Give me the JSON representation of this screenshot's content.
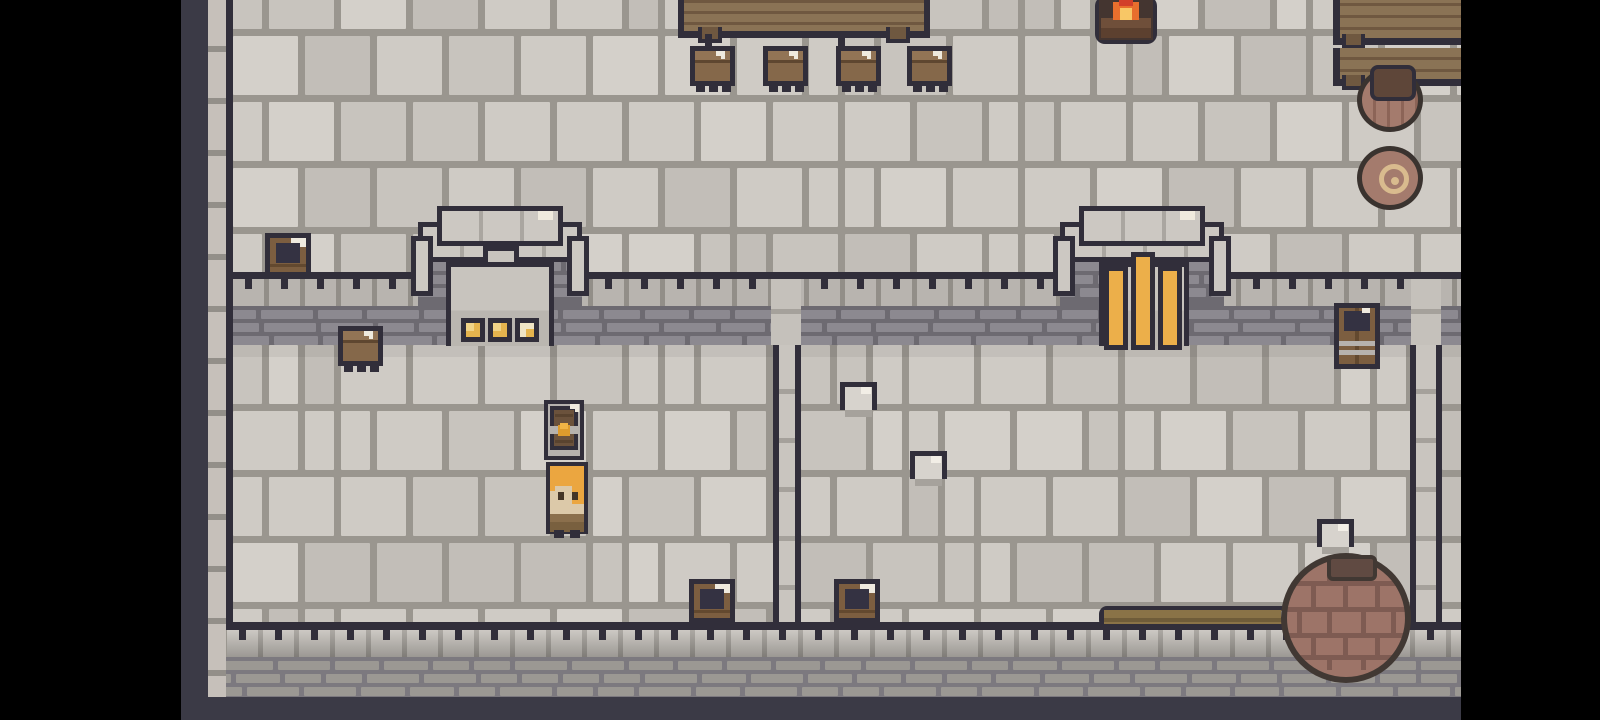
{
  "meta": {
    "scene": "pixel-art top-down castle interior",
    "visible_text": ""
  },
  "palette": {
    "letterbox": "#000000",
    "edge_slate": "#3b3a46",
    "outline": "#312e3a",
    "floor_grout": "#9a968f",
    "band_tile": "#b8b4af",
    "brick": "#8c8990",
    "brick_gap": "#6d6a71",
    "outer_brick": "#9b9893",
    "outer_brick_gap": "#7c797f",
    "wood": "#8a7355",
    "wood_dark": "#6f5840",
    "crate_wood": "#7c5e40",
    "crate_interior": "#343242",
    "highlight_white": "#efeade",
    "stone_block": "#d7d3cd",
    "stone_shadow": "#a6a29c",
    "gold": "#e5b44e",
    "portcullis_gold": "#ecaf4a",
    "clasp_gold": "#dd9b2d",
    "barrel_rose": "#a47b6d",
    "barrel_cap": "#5e4639",
    "coil": "#d9bb8e",
    "big_pot": "#9d7468",
    "big_pot_band": "#7e5b52",
    "flame_red": "#d2402a",
    "flame_orange": "#e86f2d",
    "flame_yellow": "#f8c766",
    "log": "#6f4f3a",
    "hair": "#eba640",
    "skin": "#dcc9a9",
    "eye": "#443527",
    "shirt": "#8b6f4c",
    "arch_stone": "#ccc8c2",
    "alcove": "#c8c4be"
  },
  "viewport": {
    "x": 181,
    "y": 0,
    "w": 1280,
    "h": 720
  },
  "tile_variants": [
    "#cfcbc5",
    "#cfcbc5",
    "#c8c4be",
    "#d4d0ca",
    "#c2beb8"
  ],
  "floors": [
    {
      "name": "hall-floor",
      "x": 52,
      "y": 0,
      "w": 1228,
      "h": 272,
      "oy": -30
    },
    {
      "name": "room-left-floor",
      "x": 52,
      "y": 345,
      "w": 540,
      "h": 277
    },
    {
      "name": "room-mid-floor",
      "x": 620,
      "y": 345,
      "w": 609,
      "h": 277
    },
    {
      "name": "room-right-floor",
      "x": 1261,
      "y": 345,
      "w": 19,
      "h": 277
    }
  ],
  "structure": [
    {
      "type": "shade",
      "name": "wall-shadow",
      "x": 52,
      "y": 345,
      "w": 1228,
      "h": 12
    },
    {
      "type": "line",
      "name": "hall-wall-line",
      "x": 52,
      "y": 272,
      "w": 1228,
      "h": 7
    },
    {
      "type": "tilerow-i",
      "name": "wall-tile-row",
      "x": 52,
      "y": 279,
      "w": 1228,
      "h": 27
    },
    {
      "type": "bricks-i",
      "name": "wall-brick-band",
      "x": 52,
      "y": 306,
      "w": 1228,
      "h": 39
    },
    {
      "type": "ticks",
      "name": "wall-ticks",
      "x": 52,
      "y": 279,
      "w": 1228,
      "spacing": 36
    },
    {
      "type": "bricks-i",
      "name": "arch-brick-apron",
      "x": 237,
      "y": 258,
      "w": 164,
      "h": 48
    },
    {
      "type": "bricks-i",
      "name": "arch-brick-apron",
      "x": 879,
      "y": 258,
      "w": 164,
      "h": 48
    },
    {
      "type": "divider-top",
      "name": "divider-wall-top",
      "x": 590,
      "y": 279,
      "w": 30,
      "h": 66
    },
    {
      "type": "divider-top",
      "name": "divider-wall-top",
      "x": 1230,
      "y": 279,
      "w": 30,
      "h": 66
    },
    {
      "type": "divider",
      "name": "divider-wall",
      "x": 592,
      "y": 345,
      "w": 28,
      "h": 277
    },
    {
      "type": "divider",
      "name": "divider-wall",
      "x": 1229,
      "y": 345,
      "w": 32,
      "h": 277
    },
    {
      "type": "line",
      "name": "south-wall-line",
      "x": 46,
      "y": 622,
      "w": 1234,
      "h": 8
    },
    {
      "type": "tilerow-o",
      "name": "south-tile-row",
      "x": 46,
      "y": 630,
      "w": 1234,
      "h": 27
    },
    {
      "type": "ticks",
      "name": "south-ticks",
      "x": 46,
      "y": 630,
      "w": 1234,
      "spacing": 36
    },
    {
      "type": "bricks-o",
      "name": "south-brick-band",
      "x": 27,
      "y": 657,
      "w": 1253,
      "h": 40
    },
    {
      "type": "slate",
      "name": "south-edge",
      "x": 0,
      "y": 697,
      "w": 1280,
      "h": 23
    },
    {
      "type": "slate",
      "name": "west-edge",
      "x": 0,
      "y": 0,
      "w": 27,
      "h": 720
    },
    {
      "type": "brickcol",
      "name": "west-wall-column",
      "x": 27,
      "y": 0,
      "w": 18,
      "h": 697
    },
    {
      "type": "darkline",
      "name": "west-wall-line",
      "x": 45,
      "y": 0,
      "w": 7,
      "h": 630
    }
  ],
  "entities": [
    {
      "type": "table",
      "name": "banquet-table",
      "x": 497,
      "y": -8,
      "w": 252,
      "h": 46,
      "i": true
    },
    {
      "type": "hook",
      "name": "stool-hook",
      "x": 524,
      "y": 34,
      "w": 7,
      "h": 14,
      "i": false
    },
    {
      "type": "hook",
      "name": "stool-hook",
      "x": 657,
      "y": 34,
      "w": 7,
      "h": 14,
      "i": false
    },
    {
      "type": "stool",
      "name": "stool",
      "x": 509,
      "y": 46,
      "w": 45,
      "h": 46,
      "i": true
    },
    {
      "type": "stool",
      "name": "stool",
      "x": 582,
      "y": 46,
      "w": 45,
      "h": 46,
      "i": true
    },
    {
      "type": "stool",
      "name": "stool",
      "x": 655,
      "y": 46,
      "w": 45,
      "h": 46,
      "i": true
    },
    {
      "type": "stool",
      "name": "stool",
      "x": 726,
      "y": 46,
      "w": 45,
      "h": 46,
      "i": true
    },
    {
      "type": "fire",
      "name": "campfire",
      "x": 914,
      "y": -4,
      "w": 62,
      "h": 48,
      "i": true
    },
    {
      "type": "table-r",
      "name": "table-right-upper",
      "x": 1152,
      "y": -6,
      "w": 129,
      "h": 51,
      "i": true
    },
    {
      "type": "table-r",
      "name": "table-right-lower",
      "x": 1152,
      "y": 48,
      "w": 129,
      "h": 38,
      "i": true
    },
    {
      "type": "barrel-top",
      "name": "storage-barrel",
      "x": 1176,
      "y": 68,
      "w": 66,
      "h": 64,
      "i": true
    },
    {
      "type": "pot-coil",
      "name": "rope-coil-pot",
      "x": 1176,
      "y": 146,
      "w": 66,
      "h": 64,
      "i": true
    },
    {
      "type": "crate",
      "name": "open-crate",
      "x": 84,
      "y": 233,
      "w": 46,
      "h": 44,
      "i": true
    },
    {
      "type": "cap",
      "name": "arch-cap-outer",
      "x": 237,
      "y": 222,
      "w": 164,
      "h": 40,
      "i": false
    },
    {
      "type": "cap",
      "variant": "inner",
      "name": "arch-cap-inner",
      "x": 256,
      "y": 206,
      "w": 126,
      "h": 40,
      "i": false
    },
    {
      "type": "col",
      "name": "arch-column",
      "x": 230,
      "y": 236,
      "w": 22,
      "h": 60,
      "i": false
    },
    {
      "type": "col",
      "name": "arch-column",
      "x": 386,
      "y": 236,
      "w": 22,
      "h": 60,
      "i": false
    },
    {
      "type": "notch",
      "name": "arch-notch",
      "x": 302,
      "y": 246,
      "w": 36,
      "h": 22,
      "i": false
    },
    {
      "type": "alcove",
      "name": "arch-alcove",
      "x": 265,
      "y": 262,
      "w": 108,
      "h": 84,
      "i": false
    },
    {
      "type": "gold",
      "name": "altar-gold-tile",
      "x": 280,
      "y": 318,
      "w": 24,
      "h": 24,
      "i": false
    },
    {
      "type": "gold",
      "name": "altar-gold-tile",
      "x": 307,
      "y": 318,
      "w": 24,
      "h": 24,
      "i": false
    },
    {
      "type": "gold",
      "variant": "pale",
      "name": "altar-gold-tile",
      "x": 334,
      "y": 318,
      "w": 24,
      "h": 24,
      "i": false
    },
    {
      "type": "cap",
      "name": "arch-cap-outer",
      "x": 879,
      "y": 222,
      "w": 164,
      "h": 40,
      "i": false
    },
    {
      "type": "cap",
      "variant": "inner",
      "name": "arch-cap-inner",
      "x": 898,
      "y": 206,
      "w": 126,
      "h": 40,
      "i": false
    },
    {
      "type": "col",
      "name": "arch-column",
      "x": 872,
      "y": 236,
      "w": 22,
      "h": 60,
      "i": false
    },
    {
      "type": "col",
      "name": "arch-column",
      "x": 1028,
      "y": 236,
      "w": 22,
      "h": 60,
      "i": false
    },
    {
      "type": "backing",
      "name": "gate-recess",
      "x": 918,
      "y": 262,
      "w": 90,
      "h": 84,
      "i": false
    },
    {
      "type": "bar",
      "variant": "c",
      "name": "portcullis-bar",
      "x": 950,
      "y": 252,
      "w": 24,
      "h": 98,
      "i": true
    },
    {
      "type": "bar",
      "variant": "s",
      "name": "portcullis-bar",
      "x": 923,
      "y": 266,
      "w": 24,
      "h": 84,
      "i": true
    },
    {
      "type": "bar",
      "variant": "s",
      "name": "portcullis-bar",
      "x": 977,
      "y": 266,
      "w": 24,
      "h": 84,
      "i": true
    },
    {
      "type": "stool",
      "name": "stool",
      "x": 157,
      "y": 326,
      "w": 45,
      "h": 46,
      "i": true
    },
    {
      "type": "wbarrel",
      "name": "wall-barrel",
      "x": 1153,
      "y": 303,
      "w": 46,
      "h": 66,
      "i": true
    },
    {
      "type": "chest",
      "name": "treasure-chest",
      "x": 363,
      "y": 400,
      "w": 40,
      "h": 60,
      "i": true
    },
    {
      "type": "player",
      "name": "player-character",
      "x": 365,
      "y": 462,
      "w": 42,
      "h": 76,
      "i": true
    },
    {
      "type": "block",
      "name": "stone-block",
      "x": 659,
      "y": 382,
      "w": 37,
      "h": 35,
      "i": true
    },
    {
      "type": "block",
      "name": "stone-block",
      "x": 729,
      "y": 451,
      "w": 37,
      "h": 35,
      "i": true
    },
    {
      "type": "block",
      "name": "stone-block",
      "x": 1136,
      "y": 519,
      "w": 37,
      "h": 35,
      "i": true
    },
    {
      "type": "crate",
      "name": "open-crate",
      "x": 508,
      "y": 579,
      "w": 46,
      "h": 44,
      "i": true
    },
    {
      "type": "crate",
      "name": "open-crate",
      "x": 653,
      "y": 579,
      "w": 46,
      "h": 44,
      "i": true
    },
    {
      "type": "stick",
      "name": "wooden-stick",
      "x": 918,
      "y": 606,
      "w": 204,
      "h": 22,
      "i": true
    },
    {
      "type": "bigpot",
      "name": "large-clay-pot",
      "x": 1100,
      "y": 553,
      "w": 130,
      "h": 130,
      "i": true
    }
  ]
}
